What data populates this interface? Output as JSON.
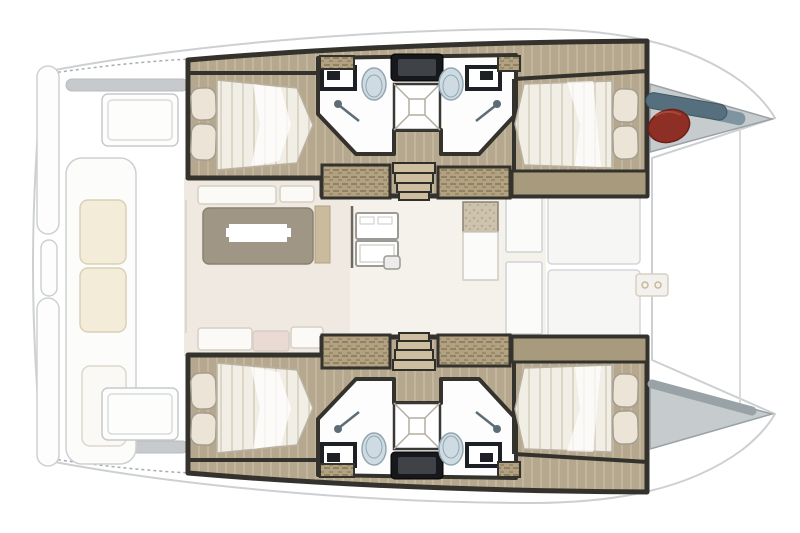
{
  "meta": {
    "subject": "Catamaran yacht deck floor plan",
    "view": "top-down",
    "bow_side": "right",
    "stern_side": "left"
  },
  "palette": {
    "background": "#ffffff",
    "outline_gray": "#cdd0d2",
    "faint_line": "#d8dadb",
    "wall_dark": "#33322c",
    "wall_black": "#17181c",
    "wood_floor": "#b6a78f",
    "wood_streak": "#cfc2a9",
    "side_deck": "#a89a7c",
    "steps_tan": "#b3a281",
    "steps_dot": "#77684c",
    "stair_tread": "#ccbe9f",
    "linen": "#f1eee6",
    "linen_stripe": "#ddd6c7",
    "pillow": "#ece5d7",
    "pillow_edge": "#a49e8f",
    "bathroom_white": "#fdfdfd",
    "porcelain": "#cfdbe2",
    "porcelain_edge": "#93a7b2",
    "fixture_dark": "#1d2125",
    "shower_line": "#b4aea0",
    "shower_metal": "#5d6d75",
    "saloon_floor": "#efe9e2",
    "saloon_floor_light": "#f5f1eb",
    "seat_white": "#fbfaf7",
    "seat_edge": "#d5d0c5",
    "seat_blush": "#e9dad3",
    "table_top": "#a09686",
    "table_edge": "#8a8071",
    "cabinet_tan": "#cabb9d",
    "speckle_base": "#cdc2ab",
    "speckle_dot": "#958a6e",
    "appliance_edge": "#9b9a94",
    "cushion_cream": "#f3ecd9",
    "cushion_edge": "#d9d0b6",
    "beam_gray": "#c7cacc",
    "bow_gray": "#c6ccce",
    "bow_gray_edge": "#9aa2a6",
    "bow_band": "#99a2a7",
    "fender_red": "#8e2f26",
    "fender_dark": "#6e1f18",
    "fender_shine": "#a8473a",
    "gear_blue": "#566f7e",
    "gear_blue_light": "#7e95a1"
  },
  "inventory": {
    "hulls": 2,
    "double_berths": 4,
    "pillows": 8,
    "toilets": 4,
    "sinks": 4,
    "shower_pans": 2,
    "shower_heads": 4,
    "deck_hatches": 2,
    "companionway_stairs": 2,
    "saloon_tables": 1,
    "galley_units": 1,
    "cockpit_benches": 3,
    "bow_fenders": 1,
    "bow_lockers": 2
  },
  "areas": {
    "port_hull": [
      "aft-double-cabin",
      "bathroom",
      "forward-double-cabin",
      "bow-locker"
    ],
    "starboard_hull": [
      "aft-double-cabin",
      "bathroom",
      "forward-double-cabin",
      "bow-locker"
    ],
    "bridgedeck": [
      "aft-cockpit",
      "saloon",
      "galley",
      "foredeck"
    ]
  }
}
